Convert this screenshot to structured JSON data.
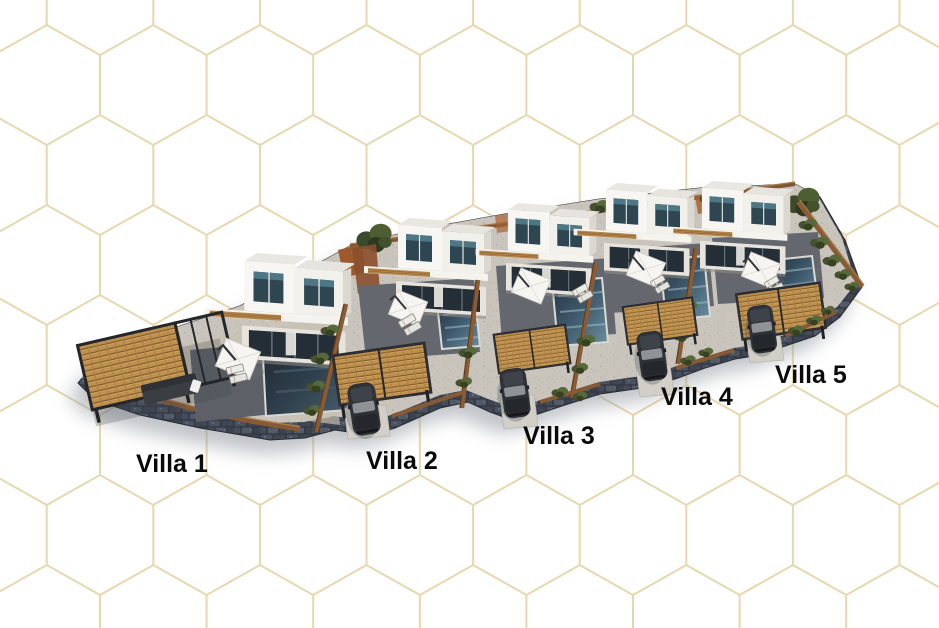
{
  "scene": {
    "description": "Aerial 3D architectural render of a row of five modern white villas, each with a private pool, sun deck, wooden carport and stone perimeter walls, on a white background with a gold geometric cube pattern"
  },
  "labels": [
    {
      "text": "Villa 1"
    },
    {
      "text": "Villa 2"
    },
    {
      "text": "Villa 3"
    },
    {
      "text": "Villa 4"
    },
    {
      "text": "Villa 5"
    }
  ],
  "colors": {
    "background": "#ffffff",
    "pattern_lines": "#e8d7ae",
    "label_text": "#0a0a0a",
    "house_walls": "#f7f6f2",
    "pool_water": "#3f5a6c",
    "wood": "#bf9150",
    "fence": "#875a34",
    "stone_wall": "#333a44",
    "paving": "#c9c5bd"
  }
}
